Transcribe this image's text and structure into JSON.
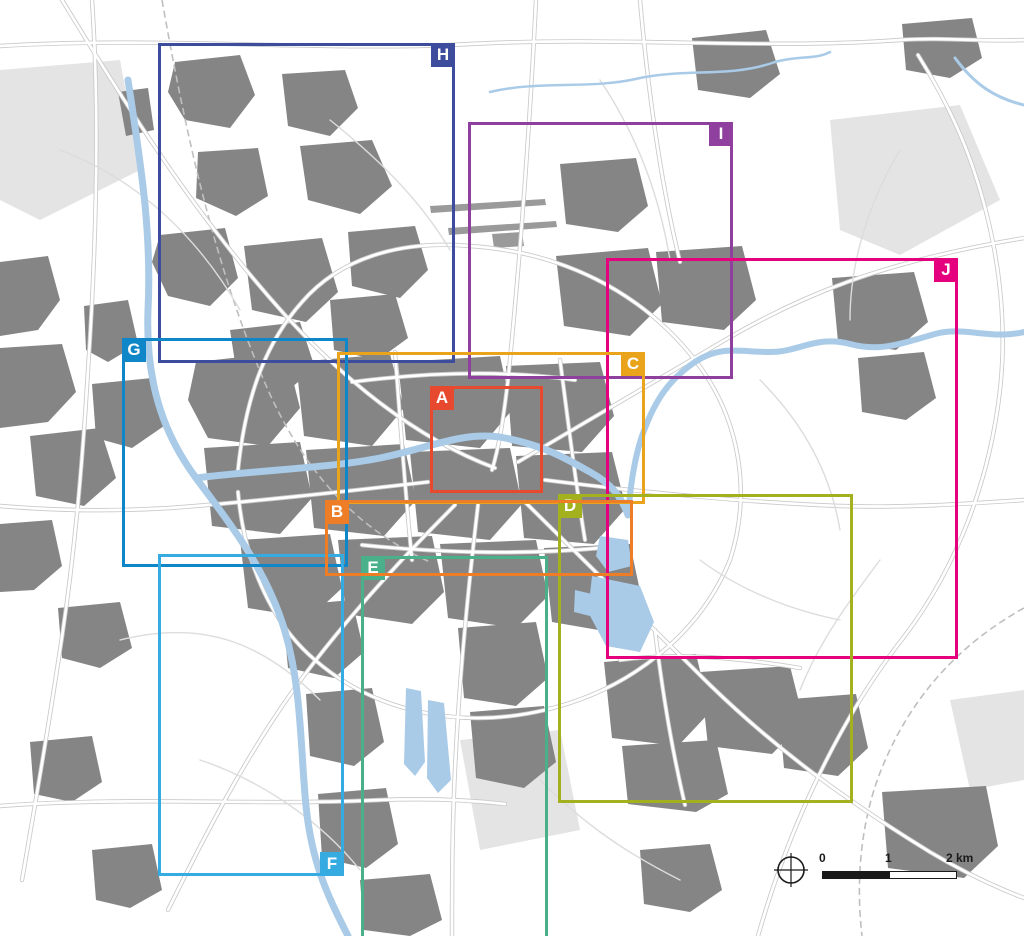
{
  "map": {
    "type": "city-overview-map",
    "colors": {
      "background": "#ffffff",
      "urban_blocks": "#858585",
      "water": "#a9cbe8",
      "road_casing": "#c9c9c9",
      "road_core": "#ffffff"
    }
  },
  "frames": [
    {
      "id": "A",
      "label": "A",
      "color": "#e6492d",
      "x": 430,
      "y": 386,
      "w": 113,
      "h": 107,
      "label_corner": "top-left"
    },
    {
      "id": "B",
      "label": "B",
      "color": "#ee7d28",
      "x": 325,
      "y": 500,
      "w": 308,
      "h": 76,
      "label_corner": "top-left"
    },
    {
      "id": "C",
      "label": "C",
      "color": "#e9a41c",
      "x": 337,
      "y": 352,
      "w": 308,
      "h": 152,
      "label_corner": "top-right"
    },
    {
      "id": "D",
      "label": "D",
      "color": "#a4b11f",
      "x": 558,
      "y": 494,
      "w": 295,
      "h": 309,
      "label_corner": "top-left"
    },
    {
      "id": "E",
      "label": "E",
      "color": "#49b08a",
      "x": 361,
      "y": 556,
      "w": 187,
      "h": 395,
      "label_corner": "top-left"
    },
    {
      "id": "F",
      "label": "F",
      "color": "#36abe2",
      "x": 158,
      "y": 554,
      "w": 186,
      "h": 322,
      "label_corner": "bottom-right"
    },
    {
      "id": "G",
      "label": "G",
      "color": "#0f86c8",
      "x": 122,
      "y": 338,
      "w": 226,
      "h": 229,
      "label_corner": "top-left"
    },
    {
      "id": "H",
      "label": "H",
      "color": "#3d4c9d",
      "x": 158,
      "y": 43,
      "w": 297,
      "h": 320,
      "label_corner": "top-right"
    },
    {
      "id": "I",
      "label": "I",
      "color": "#8f3f9d",
      "x": 468,
      "y": 122,
      "w": 265,
      "h": 257,
      "label_corner": "top-right"
    },
    {
      "id": "J",
      "label": "J",
      "color": "#e5007d",
      "x": 606,
      "y": 258,
      "w": 352,
      "h": 401,
      "label_corner": "top-right"
    }
  ],
  "frame_order": [
    "I",
    "H",
    "J",
    "G",
    "F",
    "E",
    "C",
    "D",
    "B",
    "A"
  ],
  "scalebar": {
    "tick0": "0",
    "tick1": "1",
    "tick2": "2 km"
  }
}
